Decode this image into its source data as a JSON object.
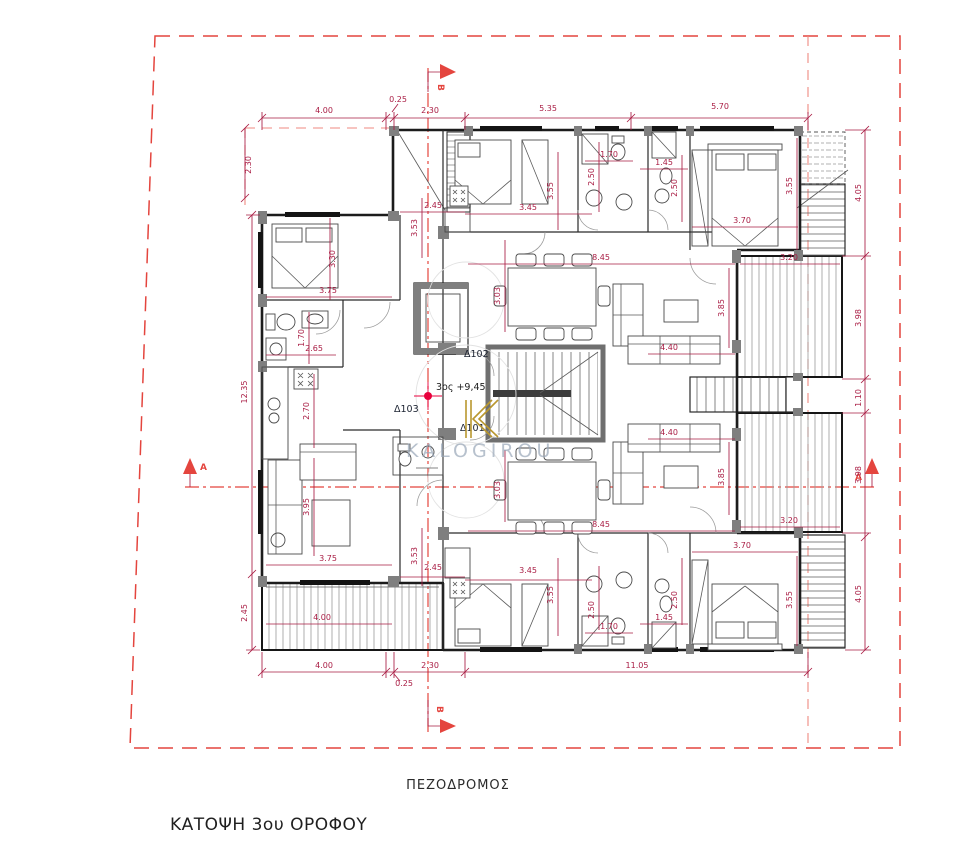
{
  "title": "ΚΑΤΟΨΗ 3ου ΟΡΟΦΟΥ",
  "street_label": "ΠΕΖΟΔΡΟΜΟΣ",
  "level_note": "3ος +9,45",
  "units": {
    "d101": "Δ101",
    "d102": "Δ102",
    "d103": "Δ103"
  },
  "section_markers": {
    "a_left": "Α",
    "a_right": "Α",
    "b_top": "Β",
    "b_bottom": "Β"
  },
  "watermark": {
    "text": "KALOGIROU",
    "logo": "K-monogram"
  },
  "colors": {
    "dimension": "#a91d44",
    "boundary_dashed": "#e4453e",
    "walls": "#1c1c1c",
    "wall_fill_gray": "#7f7f7f",
    "watermark_text": "#9aa7b8",
    "watermark_logo_gold": "#b9972f",
    "level_marker_red": "#e8003c"
  },
  "dimensions": [
    {
      "v": "4.00",
      "x": 324,
      "y": 113
    },
    {
      "v": "0.25",
      "x": 398,
      "y": 102
    },
    {
      "v": "2.30",
      "x": 430,
      "y": 113
    },
    {
      "v": "5.35",
      "x": 548,
      "y": 111
    },
    {
      "v": "5.70",
      "x": 720,
      "y": 109
    },
    {
      "v": "4.00",
      "x": 324,
      "y": 668
    },
    {
      "v": "0.25",
      "x": 404,
      "y": 686
    },
    {
      "v": "2.30",
      "x": 430,
      "y": 668
    },
    {
      "v": "11.05",
      "x": 637,
      "y": 668
    },
    {
      "v": "2.30",
      "x": 251,
      "y": 165,
      "rot": -90
    },
    {
      "v": "12.35",
      "x": 247,
      "y": 392,
      "rot": -90
    },
    {
      "v": "2.45",
      "x": 247,
      "y": 613,
      "rot": -90
    },
    {
      "v": "4.05",
      "x": 861,
      "y": 193,
      "rot": -90
    },
    {
      "v": "3.98",
      "x": 861,
      "y": 318,
      "rot": -90
    },
    {
      "v": "1.10",
      "x": 861,
      "y": 398,
      "rot": -90
    },
    {
      "v": "3.98",
      "x": 861,
      "y": 475,
      "rot": -90
    },
    {
      "v": "4.05",
      "x": 861,
      "y": 594,
      "rot": -90
    },
    {
      "v": "3.30",
      "x": 335,
      "y": 259,
      "rot": -90
    },
    {
      "v": "3.75",
      "x": 328,
      "y": 293
    },
    {
      "v": "2.65",
      "x": 314,
      "y": 351
    },
    {
      "v": "1.70",
      "x": 304,
      "y": 338,
      "rot": -90
    },
    {
      "v": "2.70",
      "x": 309,
      "y": 411,
      "rot": -90
    },
    {
      "v": "3.95",
      "x": 309,
      "y": 507,
      "rot": -90
    },
    {
      "v": "3.75",
      "x": 328,
      "y": 561
    },
    {
      "v": "4.00",
      "x": 322,
      "y": 620
    },
    {
      "v": "2.45",
      "x": 433,
      "y": 208
    },
    {
      "v": "3.53",
      "x": 417,
      "y": 228,
      "rot": -90
    },
    {
      "v": "3.45",
      "x": 528,
      "y": 210
    },
    {
      "v": "3.55",
      "x": 553,
      "y": 191,
      "rot": -90
    },
    {
      "v": "1.70",
      "x": 609,
      "y": 157
    },
    {
      "v": "2.50",
      "x": 594,
      "y": 177,
      "rot": -90
    },
    {
      "v": "1.45",
      "x": 664,
      "y": 165
    },
    {
      "v": "2.50",
      "x": 677,
      "y": 188,
      "rot": -90
    },
    {
      "v": "8.45",
      "x": 601,
      "y": 260
    },
    {
      "v": "3.03",
      "x": 500,
      "y": 296,
      "rot": -90
    },
    {
      "v": "4.40",
      "x": 669,
      "y": 350
    },
    {
      "v": "3.85",
      "x": 724,
      "y": 308,
      "rot": -90
    },
    {
      "v": "3.70",
      "x": 742,
      "y": 223
    },
    {
      "v": "3.55",
      "x": 792,
      "y": 186,
      "rot": -90
    },
    {
      "v": "3.20",
      "x": 789,
      "y": 260
    },
    {
      "v": "8.45",
      "x": 601,
      "y": 527
    },
    {
      "v": "3.03",
      "x": 500,
      "y": 490,
      "rot": -90
    },
    {
      "v": "4.40",
      "x": 669,
      "y": 435
    },
    {
      "v": "3.85",
      "x": 724,
      "y": 477,
      "rot": -90
    },
    {
      "v": "3.70",
      "x": 742,
      "y": 548
    },
    {
      "v": "3.55",
      "x": 792,
      "y": 600,
      "rot": -90
    },
    {
      "v": "3.20",
      "x": 789,
      "y": 523
    },
    {
      "v": "2.45",
      "x": 433,
      "y": 570
    },
    {
      "v": "3.53",
      "x": 417,
      "y": 556,
      "rot": -90
    },
    {
      "v": "3.45",
      "x": 528,
      "y": 573
    },
    {
      "v": "3.55",
      "x": 553,
      "y": 595,
      "rot": -90
    },
    {
      "v": "1.70",
      "x": 609,
      "y": 629
    },
    {
      "v": "2.50",
      "x": 594,
      "y": 610,
      "rot": -90
    },
    {
      "v": "1.45",
      "x": 664,
      "y": 620
    },
    {
      "v": "2.50",
      "x": 677,
      "y": 600,
      "rot": -90
    }
  ]
}
